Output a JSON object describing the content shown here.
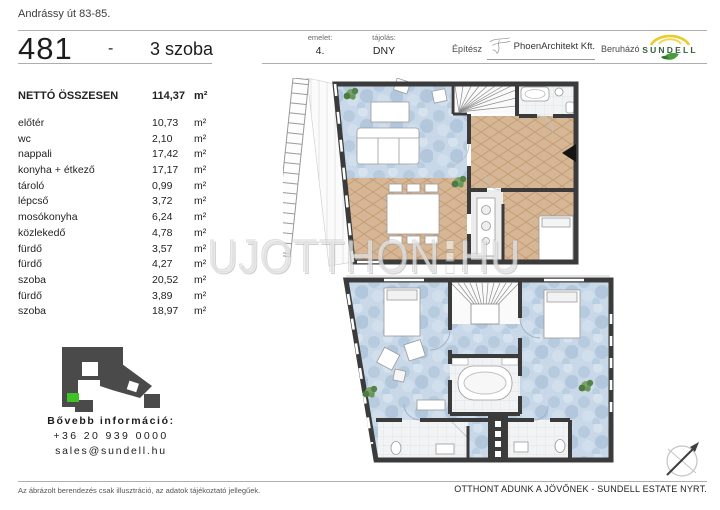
{
  "page": {
    "address": "Andrássy út 83-85.",
    "unit_number": "481",
    "separator": "-",
    "rooms_label": "3 szoba"
  },
  "header_meta": {
    "floor_label": "emelet:",
    "floor_value": "4.",
    "orientation_label": "tájolás:",
    "orientation_value": "DNY",
    "architect_label": "Építész",
    "architect_name": "PhoenArchitekt Kft.",
    "developer_label": "Beruházó",
    "developer_name": "SUNDELL"
  },
  "area_table": {
    "total_label": "NETTÓ ÖSSZESEN",
    "total_value": "114,37",
    "unit": "m²",
    "rows": [
      {
        "name": "előtér",
        "value": "10,73"
      },
      {
        "name": "wc",
        "value": "2,10"
      },
      {
        "name": "nappali",
        "value": "17,42"
      },
      {
        "name": "konyha + étkező",
        "value": "17,17"
      },
      {
        "name": "tároló",
        "value": "0,99"
      },
      {
        "name": "lépcső",
        "value": "3,72"
      },
      {
        "name": "mosókonyha",
        "value": "6,24"
      },
      {
        "name": "közlekedő",
        "value": "4,78"
      },
      {
        "name": "fürdő",
        "value": "3,57"
      },
      {
        "name": "fürdő",
        "value": "4,27"
      },
      {
        "name": "szoba",
        "value": "20,52"
      },
      {
        "name": "fürdő",
        "value": "3,89"
      },
      {
        "name": "szoba",
        "value": "18,97"
      }
    ]
  },
  "contact": {
    "more_info_label": "Bővebb információ:",
    "phone": "+36 20 939 0000",
    "email": "sales@sundell.hu"
  },
  "footer": {
    "disclaimer": "Az ábrázolt berendezés csak illusztráció, az adatok tájékoztató jellegűek.",
    "slogan": "OTTHONT ADUNK A JÖVŐNEK - SUNDELL ESTATE NYRT."
  },
  "watermark": {
    "left": "UJOTTHON",
    "right": "HU"
  },
  "icons": {
    "architect_logo": "phoenix-outline",
    "developer_logo": "sun-arc-leaf",
    "locator": "building-footprint-blocks",
    "compass": "north-arrow"
  },
  "colors": {
    "wall": "#3b3b3b",
    "carpet": "#c8d8e8",
    "wood": "#d6b694",
    "tile": "#f1f3f4",
    "unit_highlight": "#3fc226",
    "sundell_yellow": "#e9cb30",
    "sundell_green": "#3f8f34"
  }
}
